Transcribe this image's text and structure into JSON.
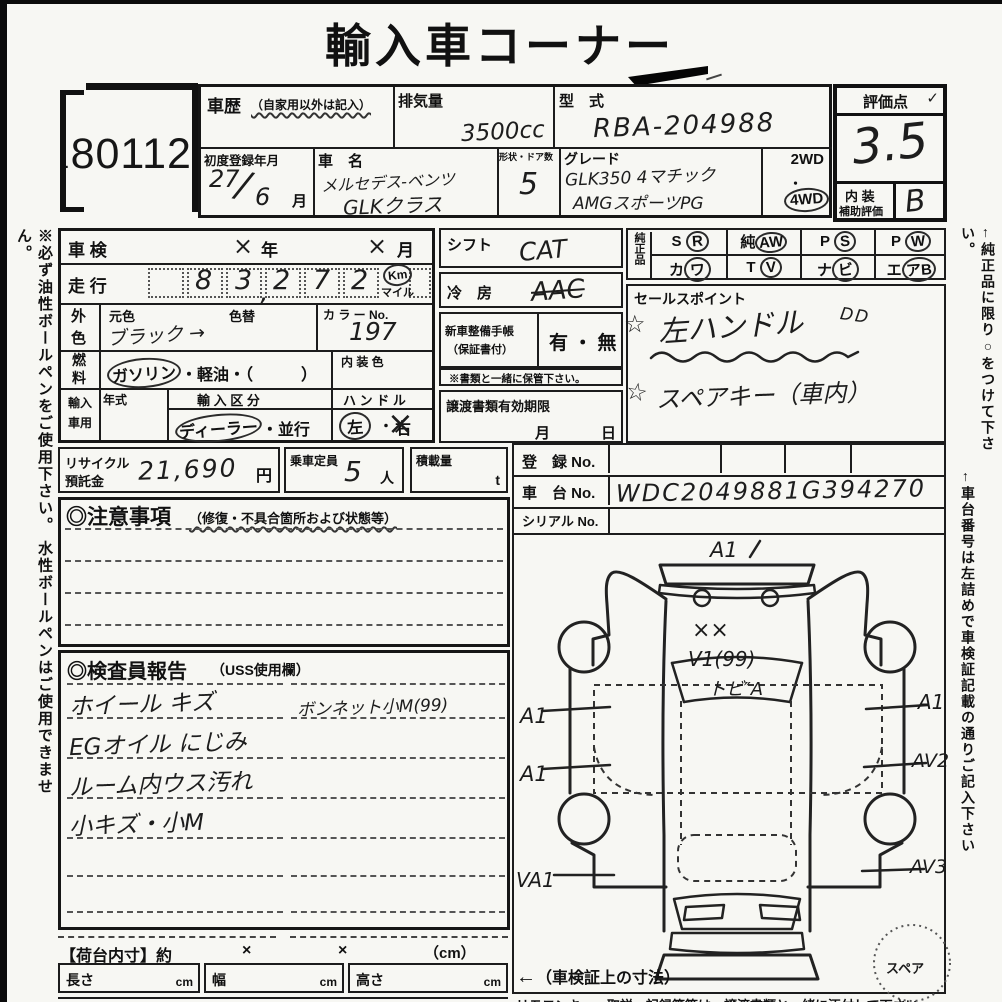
{
  "title": "輸入車コーナー",
  "side_notes": {
    "left": "※必ず油性ボールペンをご使用下さい。 水性ボールペンはご使用できません。",
    "right1": "←純正品に限り○をつけて下さい。",
    "right2": "←車台番号は左詰めで車検証記載の通りご記入下さい"
  },
  "lot": {
    "dot": ".",
    "number": "80112"
  },
  "header": {
    "history_label": "車歴",
    "history_note": "（自家用以外は記入）",
    "displacement_label": "排気量",
    "displacement_value": "3500cc",
    "model_code_label": "型　式",
    "model_code_value": "RBA-204988",
    "first_reg_label": "初度登録年月",
    "first_reg_num": "27",
    "first_reg_slash": "/",
    "first_reg_den": "6",
    "first_reg_unit": "月",
    "car_name_label": "車　名",
    "car_name_line1": "メルセデス-ベンツ",
    "car_name_line2": "GLKクラス",
    "shape_label": "形状・ドア数",
    "shape_value": "5",
    "grade_label": "グレード",
    "grade_line1": "GLK350 4マチック",
    "grade_line2": "AMGスポーツPG",
    "drive_2wd": "2WD",
    "drive_dot": "・",
    "drive_4wd": "4WD"
  },
  "score": {
    "label": "評価点",
    "check": "✓",
    "value": "3.5",
    "interior_label_1": "内 装",
    "interior_label_2": "補助評価",
    "interior_value": "B"
  },
  "left_table": {
    "shaken_label": "車 検",
    "shaken_x1": "×",
    "shaken_year": "年",
    "shaken_x2": "×",
    "shaken_month": "月",
    "mileage_label": "走 行",
    "d1": "8",
    "d2": "3",
    "comma": ",",
    "d3": "2",
    "d4": "7",
    "d5": "2",
    "km": "Km",
    "mile": "マイル",
    "color_l1": "外",
    "color_l2": "色",
    "base_label": "元色",
    "change_label": "色替",
    "color_value": "ブラック →",
    "colorno_label": "カ ラ ー No.",
    "colorno_value": "197",
    "fuel_l1": "燃",
    "fuel_l2": "料",
    "fuel_circled": "ガソリン",
    "fuel_rest": "・軽油・（　　　）",
    "intcolor_label": "内 装 色",
    "import_l1": "輸入",
    "import_l2": "車用",
    "year_label": "年式",
    "division_label": "輸 入 区 分",
    "division_circled": "ディーラー",
    "division_rest": "・並行",
    "handle_label": "ハ ン ド ル",
    "handle_left": "左",
    "handle_dot": "・",
    "handle_right": "右",
    "handle_x": "×"
  },
  "middle": {
    "shift_label": "シフト",
    "shift_value": "CAT",
    "ac_label": "冷　房",
    "ac_value": "AAC",
    "book_l1": "新車整備手帳",
    "book_l2": "（保証書付）",
    "book_value": "有 ・ 無",
    "keep_note": "※書類と一緒に保管下さい。",
    "transfer_label": "譲渡書類有効期限",
    "transfer_month": "月",
    "transfer_day": "日"
  },
  "genuine": {
    "label": "純正品",
    "items": [
      {
        "plain": "S",
        "circled": "R"
      },
      {
        "plain": "純",
        "circled": "AW"
      },
      {
        "plain": "P",
        "circled": "S"
      },
      {
        "plain": "P",
        "circled": "W"
      },
      {
        "plain": "カ",
        "circled": "ワ"
      },
      {
        "plain": "T",
        "circled": "V"
      },
      {
        "plain": "ナ",
        "circled": "ビ"
      },
      {
        "plain": "エ",
        "circled": "アB"
      }
    ]
  },
  "sales": {
    "label": "セールスポイント",
    "star1": "☆",
    "line1": "左ハンドル",
    "line1b": "DD",
    "star2": "☆",
    "line2": "スペアキー（車内）"
  },
  "recycle": {
    "label1": "リサイクル",
    "label2": "預託金",
    "value": "21,690",
    "unit": "円"
  },
  "capacity": {
    "label": "乗車定員",
    "value": "5",
    "unit": "人"
  },
  "load": {
    "label": "積載量",
    "unit": "t"
  },
  "registration": {
    "reg_label": "登　録 No.",
    "chassis_label": "車　台 No.",
    "chassis_value": "WDC2049881G394270",
    "serial_label": "シリアル No."
  },
  "cautions": {
    "title": "◎注意事項",
    "subtitle": "（修復・不具合箇所および状態等）"
  },
  "inspector": {
    "title": "◎検査員報告",
    "subtitle": "（USS使用欄）",
    "l1": "ホイール キズ",
    "l2": "EGオイル にじみ",
    "l3": "ルーム内ウス汚れ",
    "l4": "小キズ・小M",
    "r1": "ボンネット小M(99)"
  },
  "diagram": {
    "top": "A1",
    "hood_marks": "××",
    "hood_code": "V1(99)",
    "glass_code": "トビ″A",
    "left1": "A1",
    "left2": "A1",
    "left3": "VA1",
    "right1": "A1",
    "right2": "AV2",
    "right3": "AV3",
    "spare": "スペア"
  },
  "dims": {
    "title": "【荷台内寸】約",
    "x1": "×",
    "x2": "×",
    "unit": "（cm）",
    "len_label": "長さ",
    "len_unit": "cm",
    "wid_label": "幅",
    "wid_unit": "cm",
    "hei_label": "高さ",
    "hei_unit": "cm",
    "arrow": "←",
    "cert": "（車検証上の寸法）"
  },
  "bottom_cut": "リモコンキー・取説・記録簿等は、譲渡書類と一緒に添付して下さい"
}
